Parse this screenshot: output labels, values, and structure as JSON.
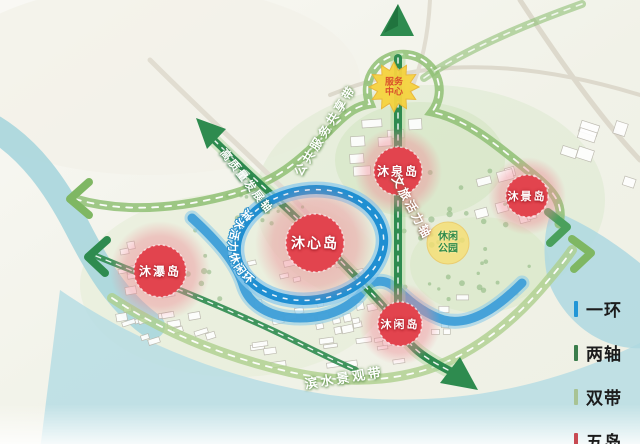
{
  "map": {
    "islands": [
      {
        "id": "muxin",
        "label": "沐心岛"
      },
      {
        "id": "muquan",
        "label": "沐泉岛"
      },
      {
        "id": "mujing",
        "label": "沐景岛"
      },
      {
        "id": "mupu",
        "label": "沐瀑岛"
      },
      {
        "id": "muxian",
        "label": "沐闲岛"
      }
    ],
    "ring_label": "滨水活力休闲环",
    "axes": {
      "culture": "文旅活力轴",
      "development": "高质量发展轴"
    },
    "belts": {
      "public_service": "公共服务共享带",
      "waterfront": "滨水景观带"
    },
    "badges": {
      "service_center": "服务中心",
      "leisure_park": "休闲公园"
    }
  },
  "legend": {
    "items": [
      {
        "label": "一环",
        "color": "#2196d6"
      },
      {
        "label": "两轴",
        "color": "#3a7d4b"
      },
      {
        "label": "双带",
        "color": "#a8c394"
      },
      {
        "label": "五岛",
        "color": "#c84a52"
      }
    ]
  },
  "colors": {
    "ring": "#1f8fd2",
    "axis": "#2e8b4f",
    "belt": "#8fbf74",
    "island": "#e2444e",
    "water": "#aed8e0",
    "stream": "#3f9fd8"
  }
}
